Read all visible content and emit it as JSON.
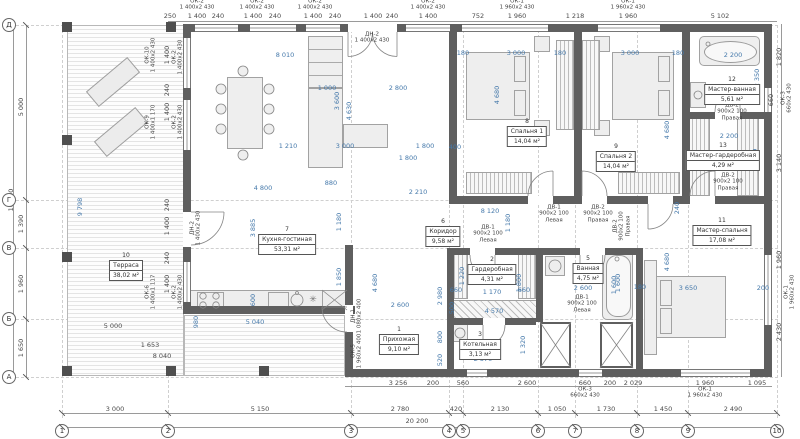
{
  "drawing_type": "floor-plan",
  "colors": {
    "wall": "#5f5f5f",
    "dim_interior": "#4478aa",
    "dim_exterior": "#4a4a4a",
    "furniture_fill": "#eeeeee"
  },
  "icons": {
    "dishwasher_symbol": "✳"
  },
  "rooms": [
    {
      "num": "7",
      "name": "Кухня-гостиная",
      "area": "53,31 м²",
      "x": 287,
      "y": 241
    },
    {
      "num": "1",
      "name": "Прихожая",
      "area": "9,10 м²",
      "x": 399,
      "y": 341
    },
    {
      "num": "2",
      "name": "Гардеробная",
      "area": "4,31 м²",
      "x": 492,
      "y": 271
    },
    {
      "num": "3",
      "name": "Котельная",
      "area": "3,13 м²",
      "x": 480,
      "y": 346
    },
    {
      "num": "5",
      "name": "Ванная",
      "area": "4,75 м²",
      "x": 588,
      "y": 270
    },
    {
      "num": "6",
      "name": "Коридор",
      "area": "9,58 м²",
      "x": 443,
      "y": 233
    },
    {
      "num": "8",
      "name": "Спальня 1",
      "area": "14,04 м²",
      "x": 527,
      "y": 133
    },
    {
      "num": "9",
      "name": "Спальня 2",
      "area": "14,04 м²",
      "x": 616,
      "y": 158
    },
    {
      "num": "12",
      "name": "Мастер-ванная",
      "area": "5,61 м²",
      "x": 732,
      "y": 91
    },
    {
      "num": "13",
      "name": "Мастер-гардеробная",
      "area": "4,29 м²",
      "x": 723,
      "y": 157
    },
    {
      "num": "11",
      "name": "Мастер-спальня",
      "area": "17,08 м²",
      "x": 722,
      "y": 232
    },
    {
      "num": "10",
      "name": "Терраса",
      "area": "38,02 м²",
      "x": 126,
      "y": 267
    }
  ],
  "grid": {
    "columns": [
      {
        "label": "1",
        "x": 62
      },
      {
        "label": "2",
        "x": 168
      },
      {
        "label": "3",
        "x": 351
      },
      {
        "label": "4",
        "x": 449
      },
      {
        "label": "5",
        "x": 463
      },
      {
        "label": "6",
        "x": 538
      },
      {
        "label": "7",
        "x": 575
      },
      {
        "label": "8",
        "x": 637
      },
      {
        "label": "9",
        "x": 688
      },
      {
        "label": "10",
        "x": 777
      }
    ],
    "rows": [
      {
        "label": "Д",
        "y": 25
      },
      {
        "label": "Г",
        "y": 200
      },
      {
        "label": "В",
        "y": 248
      },
      {
        "label": "Б",
        "y": 319
      },
      {
        "label": "А",
        "y": 377
      }
    ]
  },
  "dims": [
    {
      "t": "250",
      "x": 170,
      "y": 16,
      "c": "d"
    },
    {
      "t": "1 400",
      "x": 197,
      "y": 16,
      "c": "d"
    },
    {
      "t": "240",
      "x": 218,
      "y": 16,
      "c": "d"
    },
    {
      "t": "1 400",
      "x": 253,
      "y": 16,
      "c": "d"
    },
    {
      "t": "240",
      "x": 275,
      "y": 16,
      "c": "d"
    },
    {
      "t": "1 400",
      "x": 313,
      "y": 16,
      "c": "d"
    },
    {
      "t": "240",
      "x": 335,
      "y": 16,
      "c": "d"
    },
    {
      "t": "1 400",
      "x": 373,
      "y": 16,
      "c": "d"
    },
    {
      "t": "240",
      "x": 392,
      "y": 16,
      "c": "d"
    },
    {
      "t": "1 400",
      "x": 428,
      "y": 16,
      "c": "d"
    },
    {
      "t": "752",
      "x": 478,
      "y": 16,
      "c": "d"
    },
    {
      "t": "1 960",
      "x": 517,
      "y": 16,
      "c": "d"
    },
    {
      "t": "1 218",
      "x": 575,
      "y": 16,
      "c": "d"
    },
    {
      "t": "1 960",
      "x": 628,
      "y": 16,
      "c": "d"
    },
    {
      "t": "5 102",
      "x": 720,
      "y": 16,
      "c": "d"
    },
    {
      "t": "3 256",
      "x": 398,
      "y": 383,
      "c": "d"
    },
    {
      "t": "200",
      "x": 433,
      "y": 383,
      "c": "d"
    },
    {
      "t": "560",
      "x": 463,
      "y": 383,
      "c": "d"
    },
    {
      "t": "2 600",
      "x": 527,
      "y": 383,
      "c": "d"
    },
    {
      "t": "660",
      "x": 585,
      "y": 383,
      "c": "d"
    },
    {
      "t": "200",
      "x": 610,
      "y": 383,
      "c": "d"
    },
    {
      "t": "2 029",
      "x": 633,
      "y": 383,
      "c": "d"
    },
    {
      "t": "1 960",
      "x": 705,
      "y": 383,
      "c": "d"
    },
    {
      "t": "1 095",
      "x": 757,
      "y": 383,
      "c": "d"
    },
    {
      "t": "3 000",
      "x": 115,
      "y": 409,
      "c": "d"
    },
    {
      "t": "5 150",
      "x": 260,
      "y": 409,
      "c": "d"
    },
    {
      "t": "2 780",
      "x": 400,
      "y": 409,
      "c": "d"
    },
    {
      "t": "420",
      "x": 456,
      "y": 409,
      "c": "d"
    },
    {
      "t": "2 130",
      "x": 500,
      "y": 409,
      "c": "d"
    },
    {
      "t": "1 050",
      "x": 557,
      "y": 409,
      "c": "d"
    },
    {
      "t": "1 730",
      "x": 606,
      "y": 409,
      "c": "d"
    },
    {
      "t": "1 450",
      "x": 663,
      "y": 409,
      "c": "d"
    },
    {
      "t": "2 490",
      "x": 733,
      "y": 409,
      "c": "d"
    },
    {
      "t": "20 200",
      "x": 417,
      "y": 421,
      "c": "d"
    },
    {
      "t": "10 000",
      "x": 11,
      "y": 200,
      "c": "d",
      "r": 1
    },
    {
      "t": "5 000",
      "x": 21,
      "y": 107,
      "c": "d",
      "r": 1
    },
    {
      "t": "1 390",
      "x": 21,
      "y": 224,
      "c": "d",
      "r": 1
    },
    {
      "t": "1 960",
      "x": 21,
      "y": 284,
      "c": "d",
      "r": 1
    },
    {
      "t": "1 650",
      "x": 21,
      "y": 348,
      "c": "d",
      "r": 1
    },
    {
      "t": "1 820",
      "x": 779,
      "y": 57,
      "c": "d",
      "r": 1
    },
    {
      "t": "3 140",
      "x": 779,
      "y": 163,
      "c": "d",
      "r": 1
    },
    {
      "t": "1 960",
      "x": 779,
      "y": 260,
      "c": "d",
      "r": 1
    },
    {
      "t": "2 430",
      "x": 779,
      "y": 332,
      "c": "d",
      "r": 1
    },
    {
      "t": "660",
      "x": 771,
      "y": 100,
      "c": "d",
      "r": 1
    },
    {
      "t": "5 000",
      "x": 113,
      "y": 326,
      "c": "d"
    },
    {
      "t": "1 653",
      "x": 150,
      "y": 345,
      "c": "d"
    },
    {
      "t": "8 040",
      "x": 162,
      "y": 356,
      "c": "d"
    },
    {
      "t": "9 798",
      "x": 80,
      "y": 207,
      "c": "b",
      "r": 1
    },
    {
      "t": "1 400",
      "x": 167,
      "y": 55,
      "c": "d",
      "r": 1
    },
    {
      "t": "240",
      "x": 167,
      "y": 90,
      "c": "d",
      "r": 1
    },
    {
      "t": "1 400",
      "x": 167,
      "y": 112,
      "c": "d",
      "r": 1
    },
    {
      "t": "240",
      "x": 167,
      "y": 205,
      "c": "d",
      "r": 1
    },
    {
      "t": "1 400",
      "x": 167,
      "y": 226,
      "c": "d",
      "r": 1
    },
    {
      "t": "240",
      "x": 167,
      "y": 258,
      "c": "d",
      "r": 1
    },
    {
      "t": "1 400",
      "x": 167,
      "y": 284,
      "c": "d",
      "r": 1
    },
    {
      "t": "8 010",
      "x": 285,
      "y": 55,
      "c": "b"
    },
    {
      "t": "180",
      "x": 463,
      "y": 53,
      "c": "b"
    },
    {
      "t": "3 000",
      "x": 516,
      "y": 53,
      "c": "b"
    },
    {
      "t": "180",
      "x": 560,
      "y": 53,
      "c": "b"
    },
    {
      "t": "3 000",
      "x": 630,
      "y": 53,
      "c": "b"
    },
    {
      "t": "180",
      "x": 678,
      "y": 53,
      "c": "b"
    },
    {
      "t": "2 200",
      "x": 733,
      "y": 55,
      "c": "b"
    },
    {
      "t": "2 800",
      "x": 398,
      "y": 88,
      "c": "b"
    },
    {
      "t": "1 000",
      "x": 327,
      "y": 88,
      "c": "b"
    },
    {
      "t": "1 210",
      "x": 288,
      "y": 146,
      "c": "b"
    },
    {
      "t": "3 000",
      "x": 345,
      "y": 146,
      "c": "b"
    },
    {
      "t": "1 800",
      "x": 425,
      "y": 146,
      "c": "b"
    },
    {
      "t": "400",
      "x": 455,
      "y": 147,
      "c": "b"
    },
    {
      "t": "1 800",
      "x": 408,
      "y": 158,
      "c": "b"
    },
    {
      "t": "880",
      "x": 331,
      "y": 183,
      "c": "b"
    },
    {
      "t": "4 800",
      "x": 263,
      "y": 188,
      "c": "b"
    },
    {
      "t": "2 210",
      "x": 418,
      "y": 192,
      "c": "b"
    },
    {
      "t": "8 120",
      "x": 490,
      "y": 211,
      "c": "b"
    },
    {
      "t": "2 200",
      "x": 729,
      "y": 136,
      "c": "b"
    },
    {
      "t": "5 040",
      "x": 255,
      "y": 322,
      "c": "b"
    },
    {
      "t": "2 600",
      "x": 400,
      "y": 305,
      "c": "b"
    },
    {
      "t": "1 170",
      "x": 492,
      "y": 292,
      "c": "b"
    },
    {
      "t": "4 570",
      "x": 494,
      "y": 311,
      "c": "b"
    },
    {
      "t": "660",
      "x": 456,
      "y": 290,
      "c": "b"
    },
    {
      "t": "660",
      "x": 524,
      "y": 290,
      "c": "b"
    },
    {
      "t": "2 600",
      "x": 583,
      "y": 288,
      "c": "b"
    },
    {
      "t": "180",
      "x": 640,
      "y": 287,
      "c": "b"
    },
    {
      "t": "2 570",
      "x": 483,
      "y": 359,
      "c": "b"
    },
    {
      "t": "3 650",
      "x": 688,
      "y": 288,
      "c": "b"
    },
    {
      "t": "200",
      "x": 763,
      "y": 288,
      "c": "b"
    },
    {
      "t": "3 600",
      "x": 337,
      "y": 101,
      "c": "b",
      "r": 1
    },
    {
      "t": "4 630",
      "x": 349,
      "y": 111,
      "c": "b",
      "r": 1
    },
    {
      "t": "4 680",
      "x": 497,
      "y": 95,
      "c": "b",
      "r": 1
    },
    {
      "t": "2 350",
      "x": 757,
      "y": 78,
      "c": "b",
      "r": 1
    },
    {
      "t": "1 950",
      "x": 755,
      "y": 158,
      "c": "b",
      "r": 1
    },
    {
      "t": "4 680",
      "x": 667,
      "y": 130,
      "c": "b",
      "r": 1
    },
    {
      "t": "1 180",
      "x": 508,
      "y": 223,
      "c": "b",
      "r": 1
    },
    {
      "t": "3 885",
      "x": 253,
      "y": 228,
      "c": "b",
      "r": 1
    },
    {
      "t": "1 180",
      "x": 339,
      "y": 222,
      "c": "b",
      "r": 1
    },
    {
      "t": "1 850",
      "x": 339,
      "y": 277,
      "c": "b",
      "r": 1
    },
    {
      "t": "600",
      "x": 253,
      "y": 300,
      "c": "b",
      "r": 1
    },
    {
      "t": "980",
      "x": 196,
      "y": 322,
      "c": "b",
      "r": 1
    },
    {
      "t": "4 680",
      "x": 375,
      "y": 283,
      "c": "b",
      "r": 1
    },
    {
      "t": "2 980",
      "x": 440,
      "y": 296,
      "c": "b",
      "r": 1
    },
    {
      "t": "800",
      "x": 440,
      "y": 337,
      "c": "b",
      "r": 1
    },
    {
      "t": "520",
      "x": 440,
      "y": 360,
      "c": "b",
      "r": 1
    },
    {
      "t": "1 220",
      "x": 462,
      "y": 276,
      "c": "b",
      "r": 1
    },
    {
      "t": "1 800",
      "x": 519,
      "y": 283,
      "c": "b",
      "r": 1
    },
    {
      "t": "500",
      "x": 452,
      "y": 308,
      "c": "b",
      "r": 1
    },
    {
      "t": "1 600",
      "x": 618,
      "y": 283,
      "c": "b",
      "r": 1
    },
    {
      "t": "1 320",
      "x": 523,
      "y": 345,
      "c": "b",
      "r": 1
    },
    {
      "t": "4 680",
      "x": 667,
      "y": 262,
      "c": "b",
      "r": 1
    },
    {
      "t": "1 600",
      "x": 614,
      "y": 285,
      "c": "b",
      "r": 1
    },
    {
      "t": "240",
      "x": 677,
      "y": 208,
      "c": "b",
      "r": 1
    }
  ],
  "openings": [
    {
      "lines": [
        "ОК-2",
        "1 400х2 430"
      ],
      "x": 197,
      "y": 5
    },
    {
      "lines": [
        "ОК-2",
        "1 400х2 430"
      ],
      "x": 257,
      "y": 5
    },
    {
      "lines": [
        "ОК-2",
        "1 400х2 430"
      ],
      "x": 315,
      "y": 5
    },
    {
      "lines": [
        "ОК-2",
        "1 400х2 430"
      ],
      "x": 428,
      "y": 5
    },
    {
      "lines": [
        "ОК-1",
        "1 960х2 430"
      ],
      "x": 517,
      "y": 5
    },
    {
      "lines": [
        "ОК-1",
        "1 960х2 430"
      ],
      "x": 628,
      "y": 5
    },
    {
      "lines": [
        "ДН-2",
        "1 400х2 430"
      ],
      "x": 372,
      "y": 38
    },
    {
      "lines": [
        "ОК-4",
        "560х2 430"
      ],
      "x": 476,
      "y": 356
    },
    {
      "lines": [
        "ОК-3",
        "660х2 430"
      ],
      "x": 585,
      "y": 393
    },
    {
      "lines": [
        "ОК-1",
        "1 960х2 430"
      ],
      "x": 705,
      "y": 393
    },
    {
      "lines": [
        "ОК-10",
        "1 400х2 430"
      ],
      "x": 151,
      "y": 55,
      "r": 1
    },
    {
      "lines": [
        "ОК-2",
        "1 400х2 430"
      ],
      "x": 178,
      "y": 57,
      "r": 1
    },
    {
      "lines": [
        "ОК-9",
        "1 400х1 170"
      ],
      "x": 151,
      "y": 122,
      "r": 1
    },
    {
      "lines": [
        "ОК-2",
        "1 400х2 430"
      ],
      "x": 178,
      "y": 122,
      "r": 1
    },
    {
      "lines": [
        "ДН-2",
        "1 400х2 430"
      ],
      "x": 196,
      "y": 228,
      "r": 1
    },
    {
      "lines": [
        "ОК-6",
        "1 400х1 117"
      ],
      "x": 151,
      "y": 292,
      "r": 1
    },
    {
      "lines": [
        "ОК-2",
        "1 400х2 430"
      ],
      "x": 178,
      "y": 292,
      "r": 1
    },
    {
      "lines": [
        "ДН-1",
        "1 080х2 400"
      ],
      "x": 357,
      "y": 316,
      "r": 1
    },
    {
      "lines": [
        "ОК-5",
        "1 960х2 400"
      ],
      "x": 357,
      "y": 351,
      "r": 1
    },
    {
      "lines": [
        "ОК-3",
        "660х2 430"
      ],
      "x": 787,
      "y": 98,
      "r": 1
    },
    {
      "lines": [
        "ОК-1",
        "1 960х2 430"
      ],
      "x": 790,
      "y": 292,
      "r": 1
    }
  ],
  "door_tags": [
    {
      "lines": [
        "ДВ-1",
        "900х2 100",
        "Левая"
      ],
      "x": 554,
      "y": 214
    },
    {
      "lines": [
        "ДВ-2",
        "900х2 100",
        "Правая"
      ],
      "x": 598,
      "y": 214
    },
    {
      "lines": [
        "ДВ-1",
        "900х2 100",
        "Левая"
      ],
      "x": 488,
      "y": 234
    },
    {
      "lines": [
        "ДВ-2",
        "900х2 100",
        "Правая"
      ],
      "x": 732,
      "y": 112
    },
    {
      "lines": [
        "ДВ-2",
        "900х2 100",
        "Правая"
      ],
      "x": 728,
      "y": 182
    },
    {
      "lines": [
        "ДВ-1",
        "900х2 100",
        "Левая"
      ],
      "x": 582,
      "y": 304
    },
    {
      "lines": [
        "ДВ-2",
        "900х2 100",
        "Правая"
      ],
      "x": 622,
      "y": 226,
      "r": 1
    }
  ]
}
